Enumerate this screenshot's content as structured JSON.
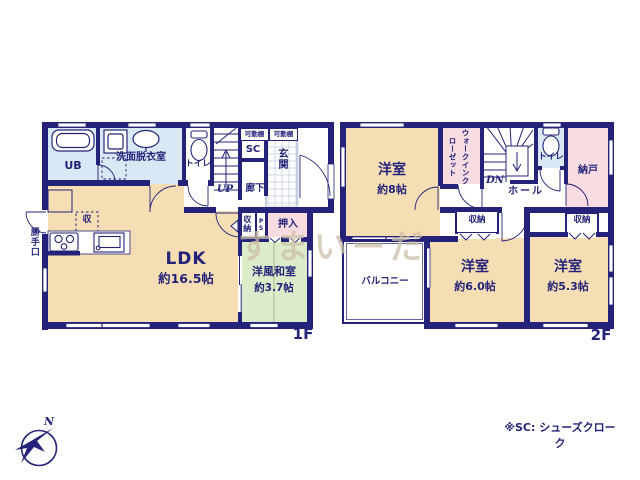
{
  "f1": {
    "label": "1F",
    "ub": "UB",
    "senmen": "洗面脱衣室",
    "toilet": "トイレ",
    "shelf_a": "可動棚",
    "shelf_b": "可動棚",
    "sc": "SC",
    "genkan": "玄関",
    "up": "UP",
    "rouka": "廊下",
    "kitchen_storage": "収",
    "katteguchi": "勝手口",
    "ldk_name": "LDK",
    "ldk_size": "約16.5帖",
    "storage": "収納",
    "ps": "PS",
    "oshiire": "押入",
    "washitsu_name": "洋風和室",
    "washitsu_size": "約3.7帖"
  },
  "f2": {
    "label": "2F",
    "bed8_name": "洋室",
    "bed8_size": "約8帖",
    "wic": "ウォークインクローゼット",
    "dn": "DN",
    "toilet": "トイレ",
    "nando": "納戸",
    "hall": "ホール",
    "storage_a": "収納",
    "storage_b": "収納",
    "balcony": "バルコニー",
    "bed6_name": "洋室",
    "bed6_size": "約6.0帖",
    "bed5_name": "洋室",
    "bed5_size": "約5.3帖"
  },
  "footer": {
    "note": "※SC: シューズクローク"
  },
  "watermark": "すまいーだ",
  "compass": {
    "north": "N"
  },
  "colors": {
    "wall": "#242379",
    "room_cream": "#F6DEB4",
    "room_green": "#DCEBC9",
    "room_pink": "#F8DCE2",
    "room_blue": "#D9E8F5",
    "watermark": "#CDBFA7"
  }
}
